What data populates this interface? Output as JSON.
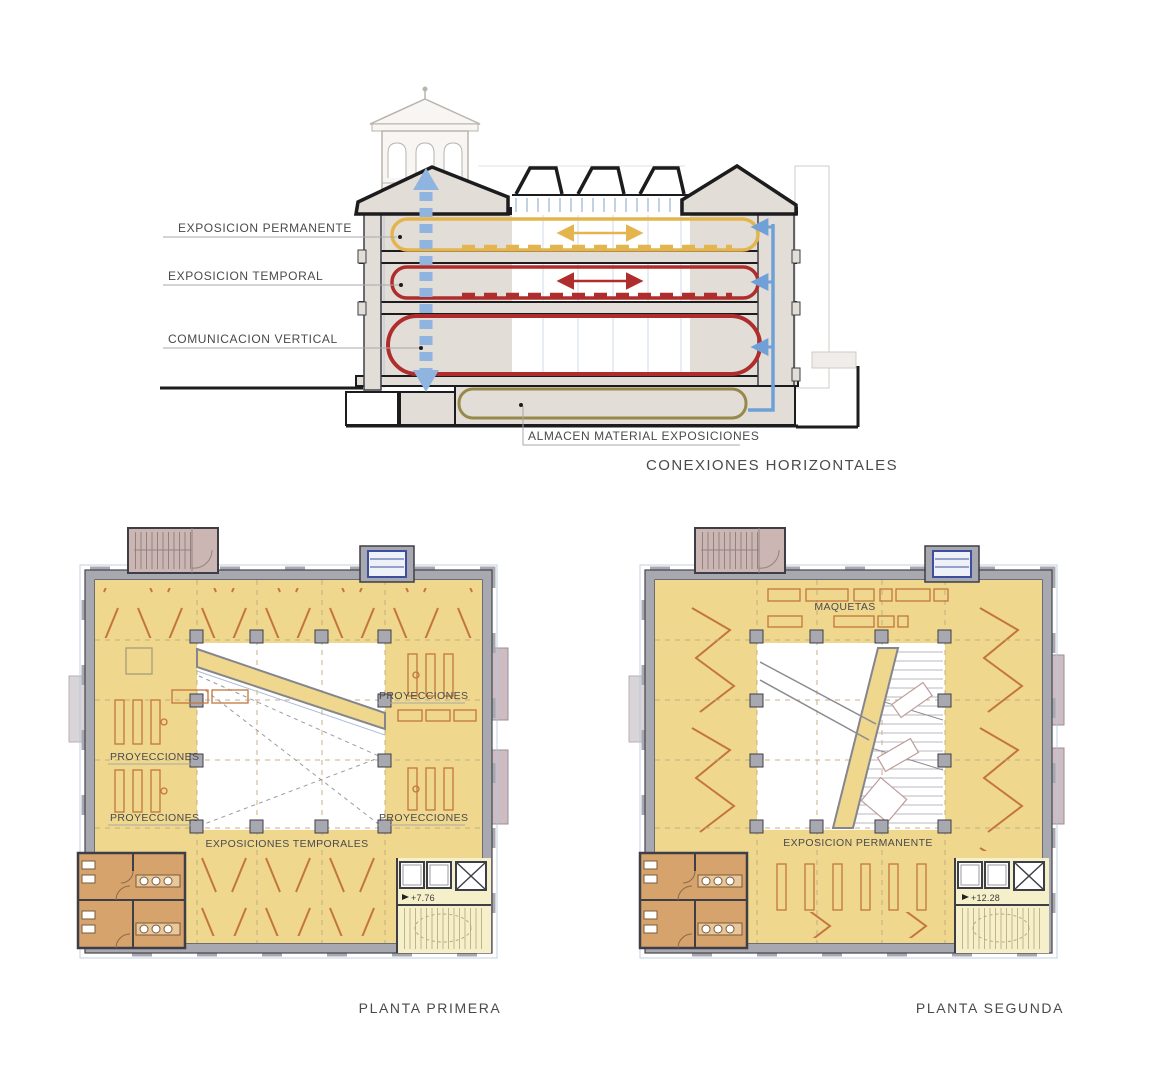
{
  "section": {
    "labels": {
      "permanente": "EXPOSICION PERMANENTE",
      "temporal": "EXPOSICION TEMPORAL",
      "vertical": "COMUNICACION VERTICAL",
      "almacen": "ALMACEN MATERIAL EXPOSICIONES"
    },
    "title": "CONEXIONES HORIZONTALES"
  },
  "plan1": {
    "title": "PLANTA PRIMERA",
    "labels": {
      "proyecciones": "PROYECCIONES",
      "exposiciones_temporales": "EXPOSICIONES TEMPORALES",
      "level": "+7.76"
    }
  },
  "plan2": {
    "title": "PLANTA SEGUNDA",
    "labels": {
      "maquetas": "MAQUETAS",
      "exposicion_permanente": "EXPOSICION PERMANENTE",
      "level": "+12.28"
    }
  },
  "colors": {
    "accent_yellow": "#E4B54E",
    "accent_red": "#AF2E2D",
    "accent_olive": "#97894B",
    "arrow_blue": "#8FB4DF",
    "line_blue": "#6FA0D8",
    "floor_yellow": "#EFD78D",
    "floor_pale": "#F6F0CA",
    "wall_gray": "#A8A8B0",
    "section_fill": "#E2DDD6",
    "hatch_orange": "#C3763C",
    "bathroom_tan": "#D7A36C",
    "stair_pink": "#CBB6B4",
    "elevator_blue": "#3C4F9E",
    "annex_pink": "#CDBDC2",
    "window_blue": "#B5C6DE",
    "text_gray": "#4A4A4E"
  }
}
